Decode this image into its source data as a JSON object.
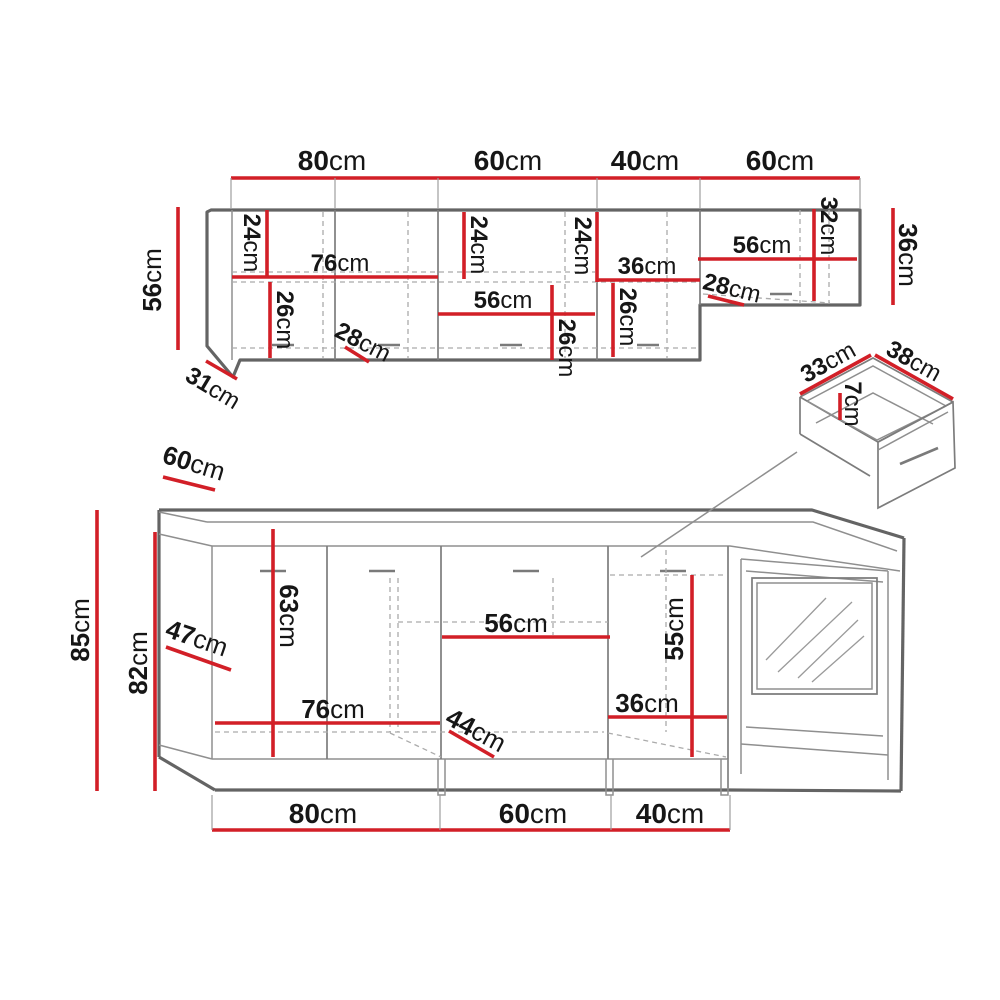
{
  "colors": {
    "dimension_red": "#d21f27",
    "outline_dark": "#646464",
    "outline_light": "#8f8f8f",
    "dashed_gray": "#ababab",
    "label_text": "#161616"
  },
  "upper_cabinets": {
    "top_widths": [
      {
        "num": "80",
        "unit": "cm"
      },
      {
        "num": "60",
        "unit": "cm"
      },
      {
        "num": "40",
        "unit": "cm"
      },
      {
        "num": "60",
        "unit": "cm"
      }
    ],
    "left_height": {
      "num": "56",
      "unit": "cm"
    },
    "right_height": {
      "num": "36",
      "unit": "cm"
    },
    "corner_depth": {
      "num": "31",
      "unit": "cm"
    },
    "inner": {
      "left_top_24": {
        "num": "24",
        "unit": "cm"
      },
      "shelf_76": {
        "num": "76",
        "unit": "cm"
      },
      "left_bottom_26": {
        "num": "26",
        "unit": "cm"
      },
      "left_depth_28": {
        "num": "28",
        "unit": "cm"
      },
      "mid_24": {
        "num": "24",
        "unit": "cm"
      },
      "mid_right_24": {
        "num": "24",
        "unit": "cm"
      },
      "mid_36": {
        "num": "36",
        "unit": "cm"
      },
      "mid_shelf_56": {
        "num": "56",
        "unit": "cm"
      },
      "mid_26": {
        "num": "26",
        "unit": "cm"
      },
      "right_26": {
        "num": "26",
        "unit": "cm"
      },
      "right_shelf_56": {
        "num": "56",
        "unit": "cm"
      },
      "right_32": {
        "num": "32",
        "unit": "cm"
      },
      "right_depth_28": {
        "num": "28",
        "unit": "cm"
      }
    }
  },
  "base_cabinets": {
    "bottom_widths": [
      {
        "num": "80",
        "unit": "cm"
      },
      {
        "num": "60",
        "unit": "cm"
      },
      {
        "num": "40",
        "unit": "cm"
      }
    ],
    "counter_depth": {
      "num": "60",
      "unit": "cm"
    },
    "total_height": {
      "num": "85",
      "unit": "cm"
    },
    "carcass_height": {
      "num": "82",
      "unit": "cm"
    },
    "corner_door_47": {
      "num": "47",
      "unit": "cm"
    },
    "inner": {
      "left_63": {
        "num": "63",
        "unit": "cm"
      },
      "shelf_76": {
        "num": "76",
        "unit": "cm"
      },
      "depth_44": {
        "num": "44",
        "unit": "cm"
      },
      "shelf_56": {
        "num": "56",
        "unit": "cm"
      },
      "shelf_36": {
        "num": "36",
        "unit": "cm"
      },
      "right_55": {
        "num": "55",
        "unit": "cm"
      }
    }
  },
  "drawer_detail": {
    "side_33": {
      "num": "33",
      "unit": "cm"
    },
    "front_38": {
      "num": "38",
      "unit": "cm"
    },
    "depth_7": {
      "num": "7",
      "unit": "cm"
    }
  }
}
